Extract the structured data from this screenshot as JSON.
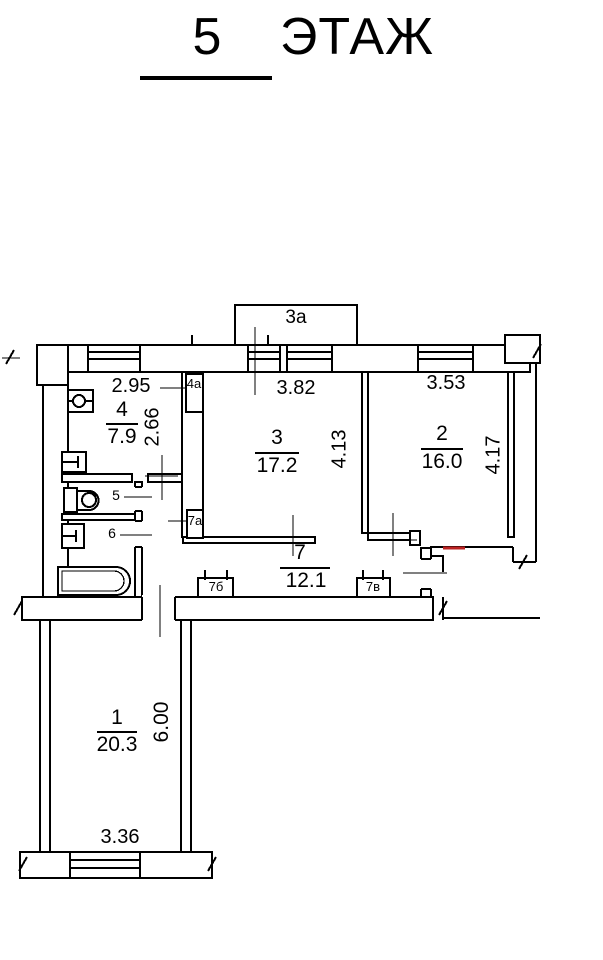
{
  "title": {
    "floor_number": "5",
    "floor_word": "ЭТАЖ"
  },
  "balcony": {
    "label": "3а"
  },
  "rooms": {
    "room1": {
      "number": "1",
      "area": "20.3",
      "dim_w": "3.36",
      "dim_h": "6.00"
    },
    "room2": {
      "number": "2",
      "area": "16.0",
      "dim_w": "3.53",
      "dim_h": "4.17"
    },
    "room3": {
      "number": "3",
      "area": "17.2",
      "dim_w": "3.82",
      "dim_h": "4.13"
    },
    "room4": {
      "number": "4",
      "area": "7.9",
      "dim_w": "2.95",
      "dim_h": "2.66"
    },
    "room5": {
      "number": "5"
    },
    "room6": {
      "number": "6"
    },
    "room7": {
      "number": "7",
      "area": "12.1"
    }
  },
  "closets": {
    "c4a": {
      "label": "4а"
    },
    "c7a": {
      "label": "7а"
    },
    "c7b": {
      "label": "7б"
    },
    "c7v": {
      "label": "7в"
    }
  },
  "colors": {
    "line": "#000000",
    "background": "#ffffff",
    "red_mark": "#bb2222"
  }
}
